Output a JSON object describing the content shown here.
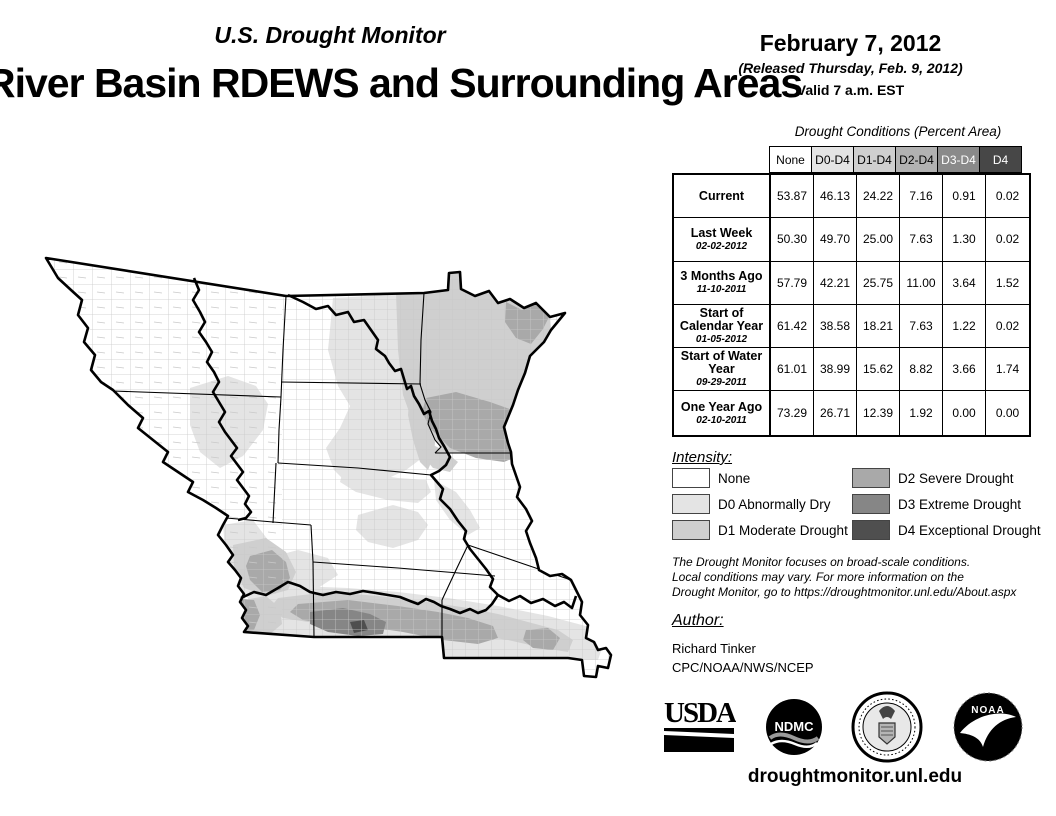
{
  "header": {
    "monitor_title": "U.S. Drought Monitor",
    "map_title": "River Basin RDEWS and Surrounding Areas",
    "date": "February 7, 2012",
    "released": "(Released Thursday, Feb. 9, 2012)",
    "valid": "Valid 7 a.m. EST"
  },
  "table": {
    "title": "Drought Conditions (Percent Area)",
    "columns": [
      "None",
      "D0-D4",
      "D1-D4",
      "D2-D4",
      "D3-D4",
      "D4"
    ],
    "column_colors": [
      "#ffffff",
      "#e4e4e4",
      "#cfcfcf",
      "#b2b2b2",
      "#8a8a8a",
      "#474747"
    ],
    "column_text_colors": [
      "#000000",
      "#000000",
      "#000000",
      "#000000",
      "#ffffff",
      "#ffffff"
    ],
    "rows": [
      {
        "label": "Current",
        "date": "",
        "values": [
          "53.87",
          "46.13",
          "24.22",
          "7.16",
          "0.91",
          "0.02"
        ]
      },
      {
        "label": "Last Week",
        "date": "02-02-2012",
        "values": [
          "50.30",
          "49.70",
          "25.00",
          "7.63",
          "1.30",
          "0.02"
        ]
      },
      {
        "label": "3 Months Ago",
        "date": "11-10-2011",
        "values": [
          "57.79",
          "42.21",
          "25.75",
          "11.00",
          "3.64",
          "1.52"
        ]
      },
      {
        "label": "Start of Calendar Year",
        "date": "01-05-2012",
        "values": [
          "61.42",
          "38.58",
          "18.21",
          "7.63",
          "1.22",
          "0.02"
        ]
      },
      {
        "label": "Start of Water Year",
        "date": "09-29-2011",
        "values": [
          "61.01",
          "38.99",
          "15.62",
          "8.82",
          "3.66",
          "1.74"
        ]
      },
      {
        "label": "One Year Ago",
        "date": "02-10-2011",
        "values": [
          "73.29",
          "26.71",
          "12.39",
          "1.92",
          "0.00",
          "0.00"
        ]
      }
    ]
  },
  "legend": {
    "title": "Intensity:",
    "items": [
      {
        "label": "None",
        "color": "#ffffff"
      },
      {
        "label": "D0 Abnormally Dry",
        "color": "#e4e4e4"
      },
      {
        "label": "D1 Moderate Drought",
        "color": "#cfcfcf"
      },
      {
        "label": "D2 Severe Drought",
        "color": "#a9a9a9"
      },
      {
        "label": "D3 Extreme Drought",
        "color": "#868686"
      },
      {
        "label": "D4 Exceptional Drought",
        "color": "#4f4f4f"
      }
    ]
  },
  "disclaimer": {
    "line1": "The Drought Monitor focuses on broad-scale conditions.",
    "line2": "Local conditions may vary. For more information on the",
    "line3": "Drought Monitor, go to https://droughtmonitor.unl.edu/About.aspx"
  },
  "author": {
    "title": "Author:",
    "name": "Richard Tinker",
    "org": "CPC/NOAA/NWS/NCEP"
  },
  "logos": {
    "usda": "USDA",
    "ndmc": "NDMC",
    "doc": "Department of Commerce",
    "noaa": "NOAA"
  },
  "footer": {
    "url": "droughtmonitor.unl.edu"
  }
}
